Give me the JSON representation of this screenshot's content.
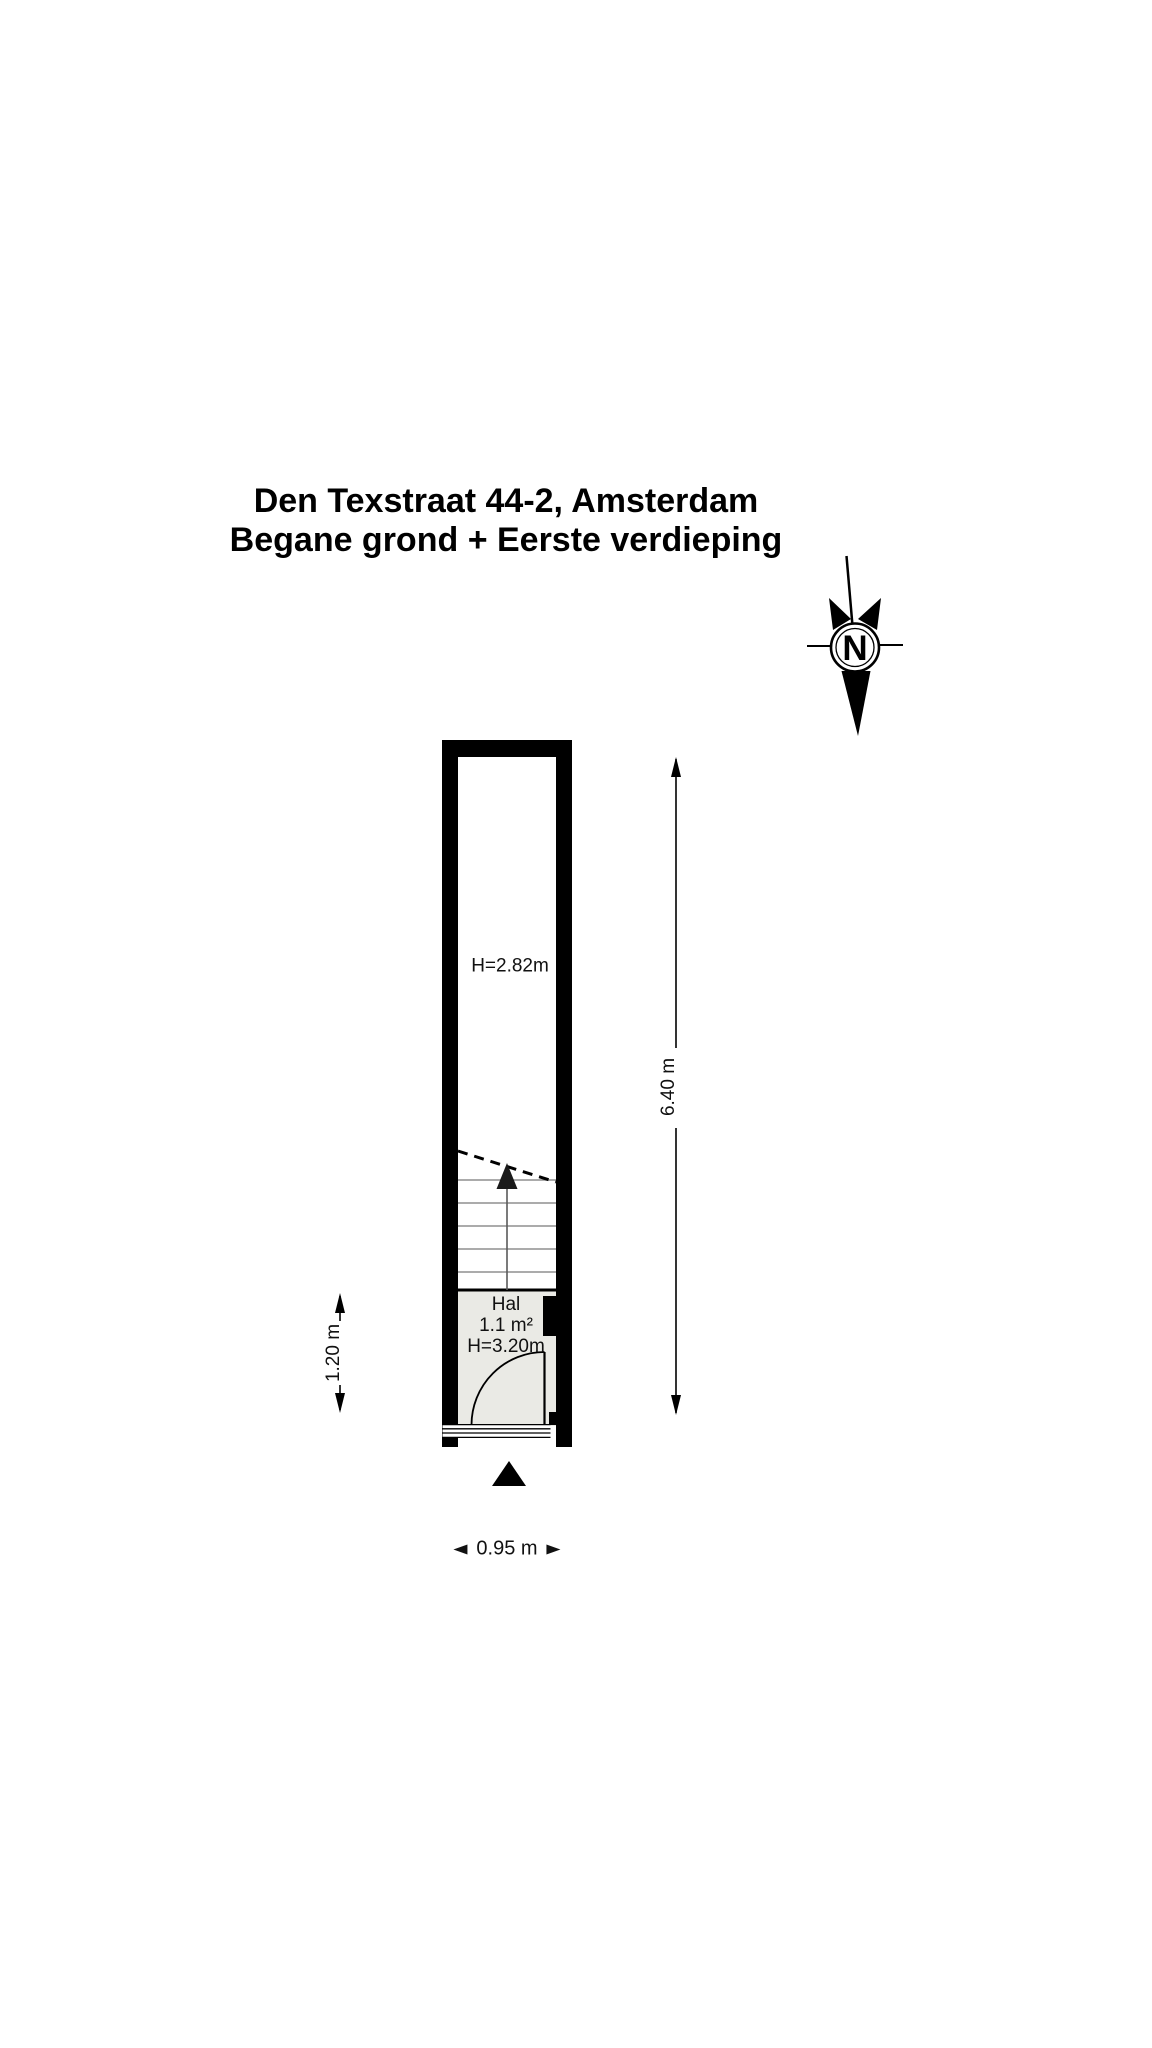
{
  "title": {
    "line1": "Den Texstraat 44-2, Amsterdam",
    "line2": "Begane grond + Eerste verdieping"
  },
  "compass": {
    "label": "N"
  },
  "floor_plan": {
    "upper_room": {
      "ceiling_height_label": "H=2.82m"
    },
    "hal": {
      "name": "Hal",
      "area_label": "1.1 m²",
      "ceiling_height_label": "H=3.20m"
    },
    "stairs": {
      "tread_count": 5
    }
  },
  "dimensions": {
    "overall_depth": "6.40 m",
    "hal_depth": "1.20 m",
    "overall_width": "0.95 m"
  },
  "colors": {
    "wall": "#000000",
    "hal_floor": "#eaeae5",
    "stair_tread": "#8f8f8f",
    "background": "#ffffff"
  }
}
